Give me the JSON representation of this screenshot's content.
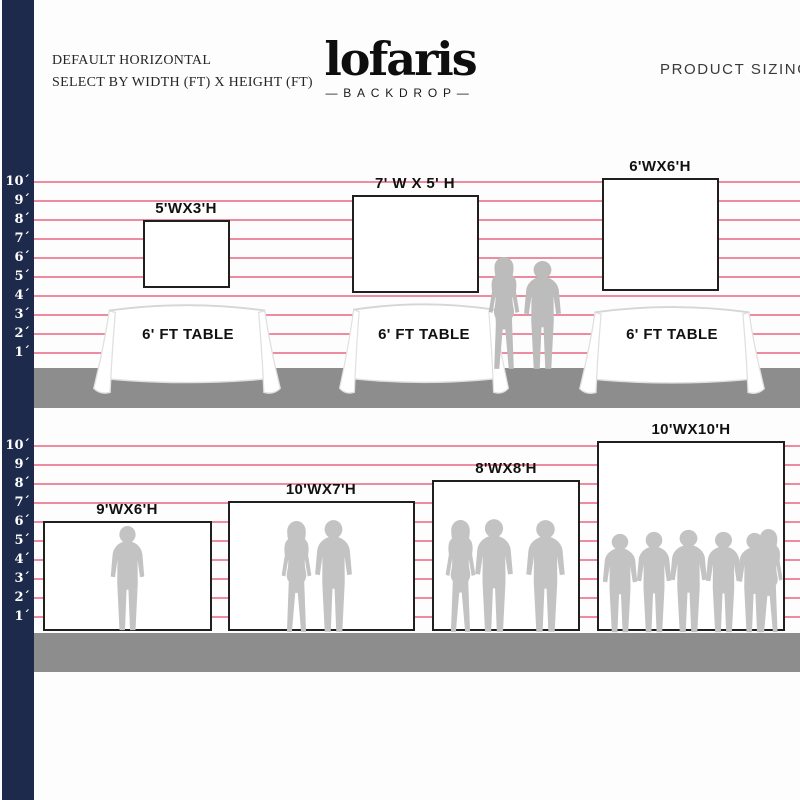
{
  "header": {
    "title_line1": "DEFAULT HORIZONTAL",
    "title_line2": "SELECT BY WIDTH (FT) X HEIGHT (FT)",
    "brand_name": "lofaris",
    "brand_tagline": "BACKDROP",
    "brand_dash": "—",
    "title_right": "PRODUCT SIZING"
  },
  "ruler": {
    "labels": [
      "10´",
      "9´",
      "8´",
      "7´",
      "6´",
      "5´",
      "4´",
      "3´",
      "2´",
      "1´"
    ]
  },
  "scene_table": {
    "backdrops": [
      {
        "label": "5'WX3'H"
      },
      {
        "label": "7' W X 5' H"
      },
      {
        "label": "6'WX6'H"
      }
    ],
    "table_label": "6' FT TABLE"
  },
  "scene_floor": {
    "backdrops": [
      {
        "label": "9'WX6'H"
      },
      {
        "label": "10'WX7'H"
      },
      {
        "label": "8'WX8'H"
      },
      {
        "label": "10'WX10'H"
      }
    ]
  },
  "colors": {
    "navy_bar": "#1e2a4c",
    "grid_line_pink": "#ef8ba0",
    "ground_gray": "#8d8d8d",
    "silhouette_gray": "#c3c3c3",
    "backdrop_border": "#1f1f1f"
  }
}
